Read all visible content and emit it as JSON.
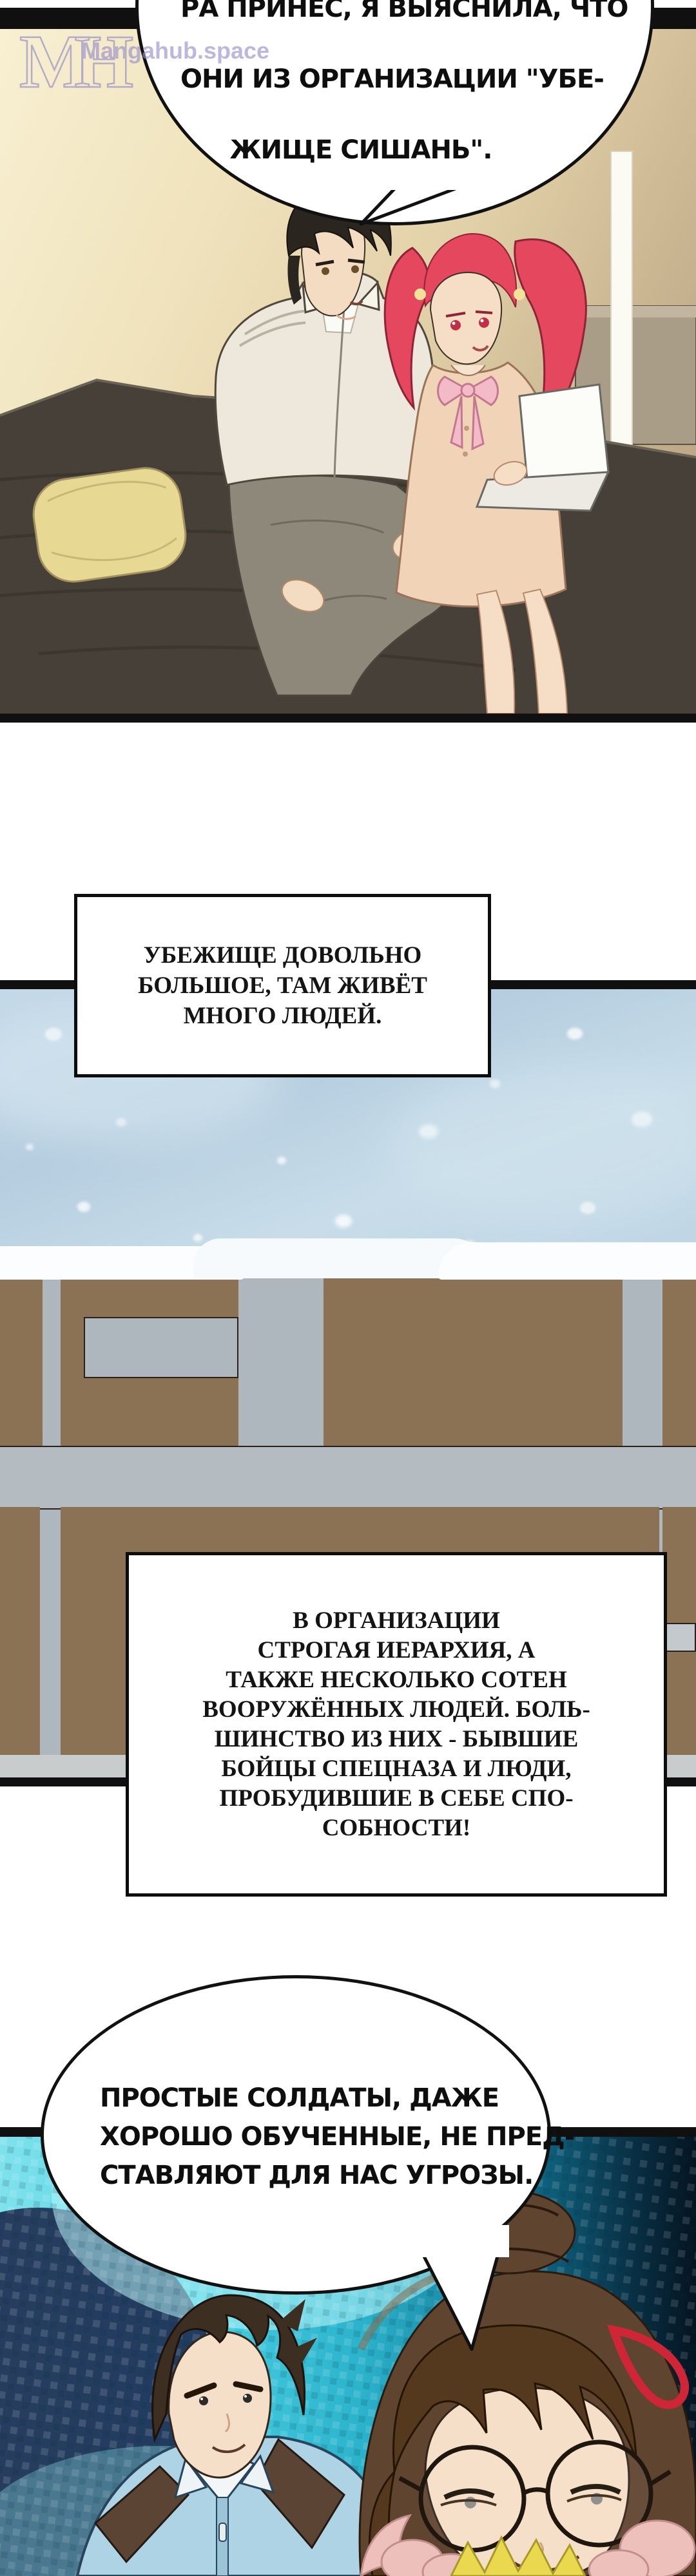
{
  "watermark": {
    "logo": "MH",
    "site": "Mangahub.space"
  },
  "bubble_top": {
    "lines": [
      "РА ПРИНЁС, Я ВЫЯСНИЛА, ЧТО",
      "ОНИ ИЗ ОРГАНИЗАЦИИ \"УБЕ-",
      "ЖИЩЕ СИШАНЬ\"."
    ]
  },
  "caption_shelter": {
    "lines": [
      "УБЕЖИЩЕ ДОВОЛЬНО",
      "БОЛЬШОЕ, ТАМ ЖИВЁТ",
      "МНОГО ЛЮДЕЙ."
    ]
  },
  "caption_org": {
    "lines": [
      "В ОРГАНИЗАЦИИ",
      "СТРОГАЯ ИЕРАРХИЯ, А",
      "ТАКЖЕ НЕСКОЛЬКО СОТЕН",
      "ВООРУЖЁННЫХ ЛЮДЕЙ. БОЛЬ-",
      "ШИНСТВО ИЗ НИХ - БЫВШИЕ",
      "БОЙЦЫ СПЕЦНАЗА И ЛЮДИ,",
      "ПРОБУДИВШИЕ В СЕБЕ СПО-",
      "СОБНОСТИ!"
    ]
  },
  "bubble_soldiers": {
    "lines": [
      "ПРОСТЫЕ СОЛДАТЫ, ДАЖЕ",
      "ХОРОШО ОБУЧЕННЫЕ, НЕ ПРЕД-",
      "СТАВЛЯЮТ ДЛЯ НАС УГРОЗЫ."
    ]
  },
  "colors": {
    "watermark_lavender": "#958cce",
    "panel_cream": "#e9d9b5",
    "bed_dark": "#474038",
    "pillow_yellow": "#e7d893",
    "snow_sky_blue": "#bcd3e4",
    "wall_gray": "#aeb7bd",
    "wall_brown": "#8b7254",
    "teal_bright": "#49cfe2",
    "teal_navy": "#1d2b50",
    "girl_hair_red": "#e5485e",
    "dress_peach": "#f1d3b8",
    "bow_pink": "#f3bac8",
    "polo_blue": "#aed3e4",
    "hairpin_red": "#cf2637",
    "collar_yellow": "#ead94f",
    "fur_pink": "#eec0bc"
  }
}
